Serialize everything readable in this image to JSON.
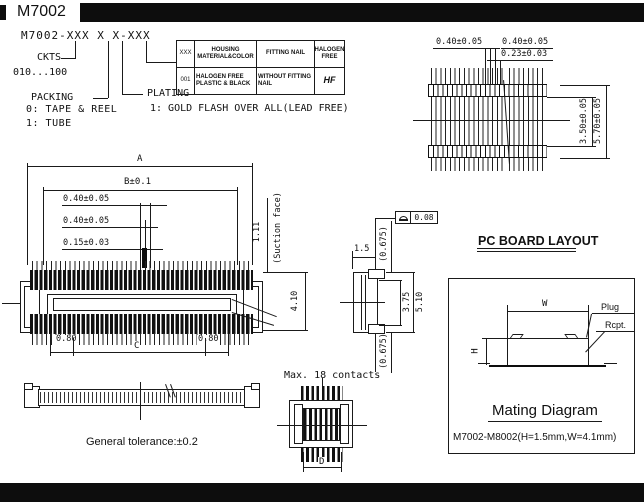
{
  "page": {
    "title": "M7002"
  },
  "pn": {
    "part_number": "M7002-XXX X X-XXX",
    "ckts_label": "CKTS",
    "ckts_range": "010...100",
    "packing_label": "PACKING",
    "packing_0": "0: TAPE & REEL",
    "packing_1": "1: TUBE",
    "plating_label": "PLATING",
    "plating_1": "1: GOLD FLASH OVER ALL(LEAD FREE)"
  },
  "table": {
    "col_code": "XXX",
    "col_housing": "HOUSING MATERIAL&COLOR",
    "col_fitting": "FITTING NAIL",
    "col_halogen": "HALOGEN FREE",
    "row_code": "001",
    "row_housing": "HALOGEN FREE PLASTIC & BLACK",
    "row_fitting": "WITHOUT FITTING NAIL",
    "row_halogen_icon": "HF"
  },
  "pcb": {
    "title": "PC BOARD LAYOUT",
    "pad_left": "0.40±0.05",
    "pad_right": "0.40±0.05",
    "gap": "0.23±0.03",
    "span_inner": "3.50±0.05",
    "span_outer": "5.70±0.05"
  },
  "front": {
    "a": "A",
    "b": "B±0.1",
    "p1": "0.40±0.05",
    "p2": "0.40±0.05",
    "p3": "0.15±0.03",
    "suction": "1.11",
    "suction_note": "(Suction face)",
    "height": "4.10",
    "end_l": "0.80",
    "end_r": "0.80",
    "c": "C"
  },
  "side": {
    "w": "1.5",
    "top": "(0.675)",
    "bottom": "(0.675)",
    "inner": "3.75",
    "outer": "5.10",
    "profile": "0.08"
  },
  "mating": {
    "title": "Mating Diagram",
    "w": "W",
    "h": "H",
    "plug": "Plug",
    "rcpt": "Rcpt.",
    "note": "M7002-M8002(H=1.5mm,W=4.1mm)"
  },
  "notes": {
    "tol": "General tolerance:±0.2",
    "contacts": "Max. 18 contacts",
    "d": "D"
  }
}
